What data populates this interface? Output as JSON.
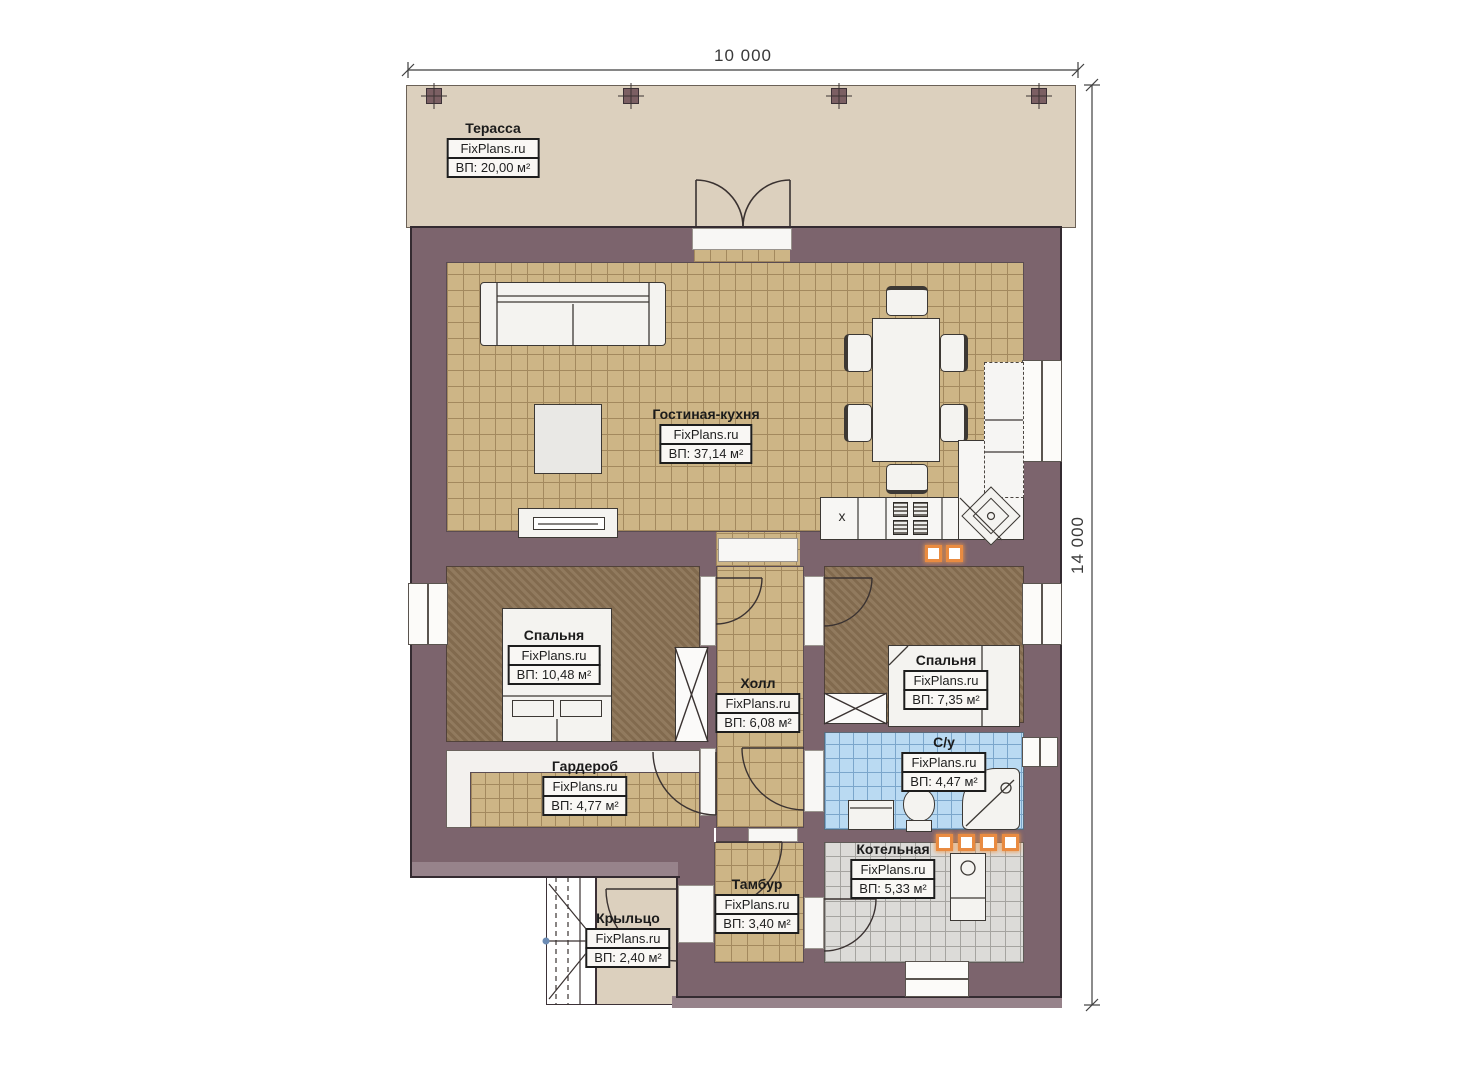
{
  "dimensions": {
    "width_label": "10 000",
    "height_label": "14 000"
  },
  "branding": {
    "label": "FixPlans.ru"
  },
  "rooms": [
    {
      "id": "terrace",
      "name": "Терасса",
      "area": "ВП: 20,00 м²"
    },
    {
      "id": "living_kitchen",
      "name": "Гостиная-кухня",
      "area": "ВП: 37,14 м²"
    },
    {
      "id": "bedroom_left",
      "name": "Спальня",
      "area": "ВП: 10,48 м²"
    },
    {
      "id": "hall",
      "name": "Холл",
      "area": "ВП: 6,08 м²"
    },
    {
      "id": "bedroom_right",
      "name": "Спальня",
      "area": "ВП: 7,35 м²"
    },
    {
      "id": "wardrobe",
      "name": "Гардероб",
      "area": "ВП: 4,77 м²"
    },
    {
      "id": "bathroom",
      "name": "С/у",
      "area": "ВП: 4,47 м²"
    },
    {
      "id": "boiler",
      "name": "Котельная",
      "area": "ВП: 5,33 м²"
    },
    {
      "id": "tambour",
      "name": "Тамбур",
      "area": "ВП: 3,40 м²"
    },
    {
      "id": "porch",
      "name": "Крыльцо",
      "area": "ВП: 2,40 м²"
    }
  ],
  "kitchen": {
    "fridge_mark": "x"
  },
  "colors": {
    "wall": "#7c646d",
    "floor_tile": "#cdb586",
    "carpet": "#8b7355",
    "bathroom_tile": "#badaf2",
    "boiler_tile": "#dcdbd8",
    "terrace": "#dcd0be",
    "vent_accent": "#e98b41"
  }
}
